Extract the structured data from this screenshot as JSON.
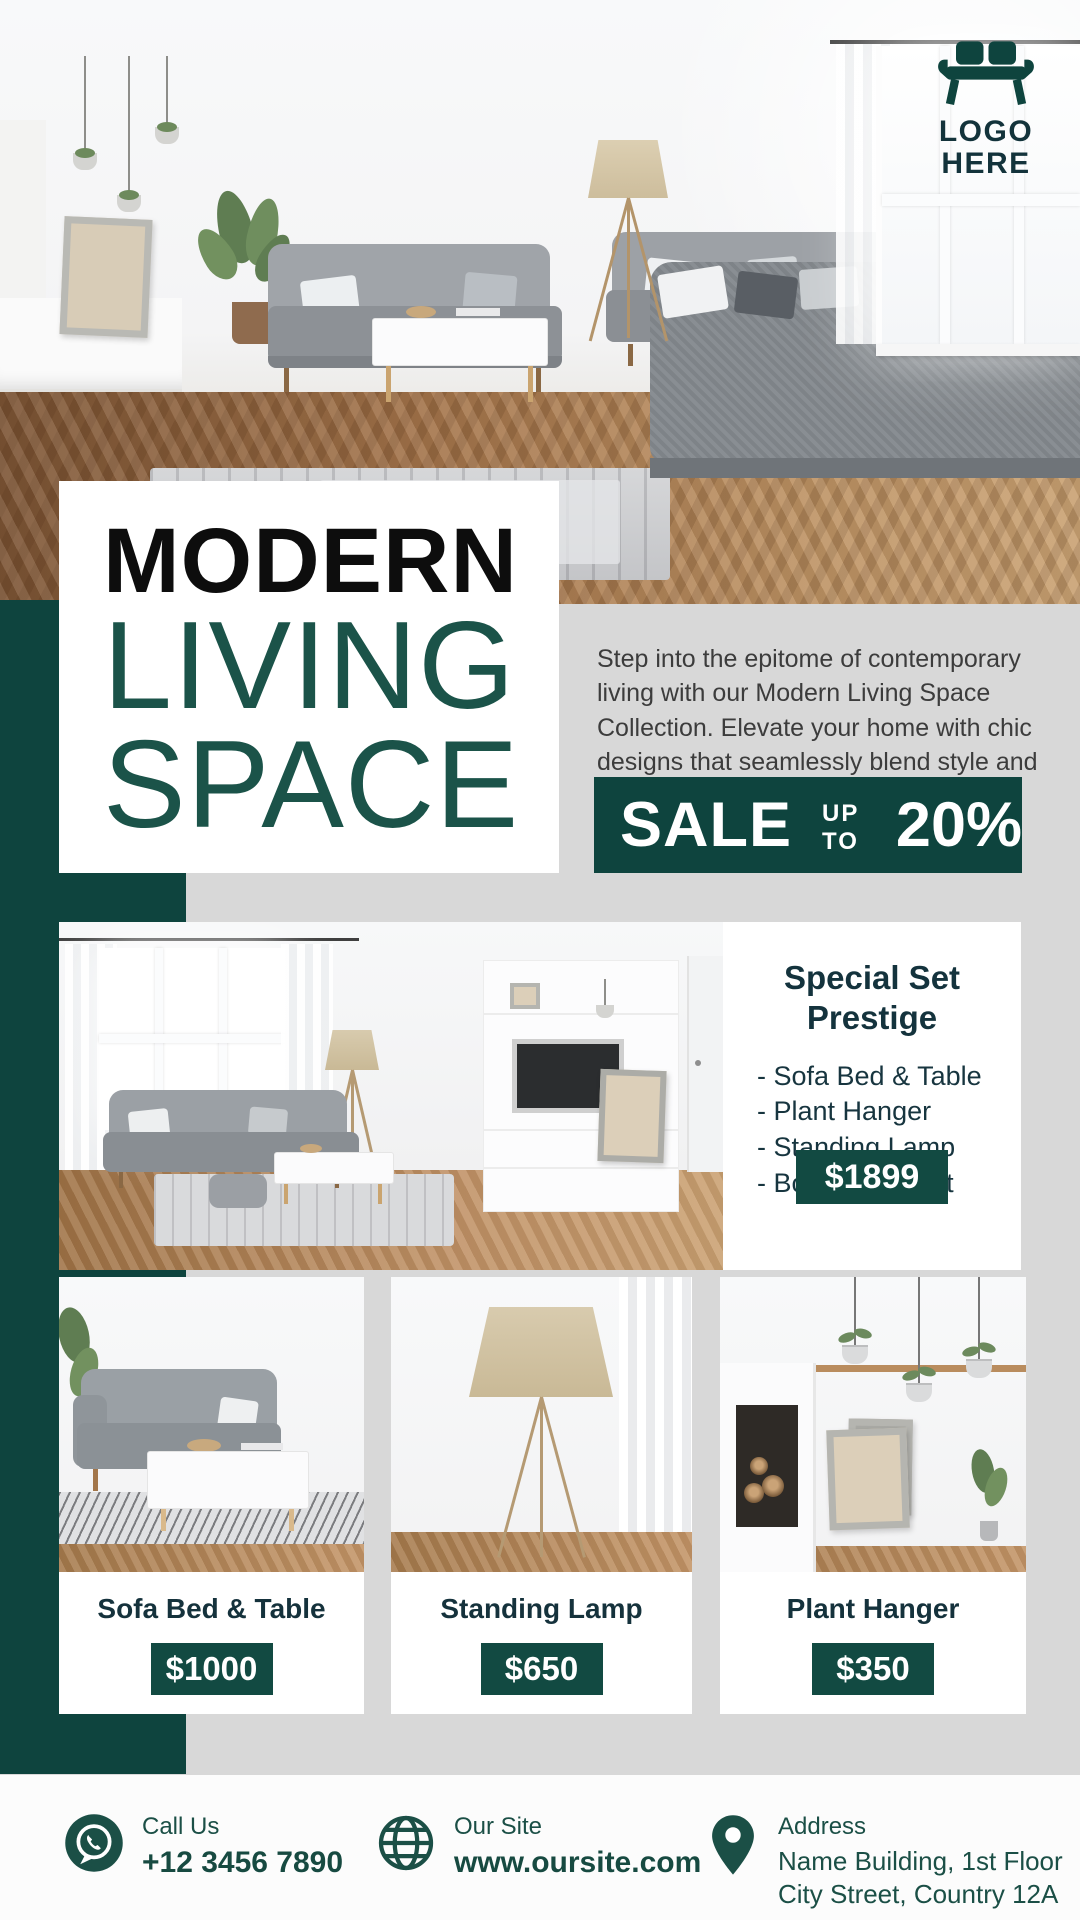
{
  "logo": {
    "icon": "sofa-icon",
    "line1": "LOGO",
    "line2": "HERE"
  },
  "title": {
    "word1": "MODERN",
    "word2": "LIVING",
    "word3": "SPACE"
  },
  "intro": "Step into the epitome of contemporary living with our Modern Living Space Collection. Elevate your home with chic designs that seamlessly blend style and comfort.",
  "sale": {
    "label": "SALE",
    "upto": "UP TO",
    "percent": "20%"
  },
  "special": {
    "title_line1": "Special Set",
    "title_line2": "Prestige",
    "items": [
      "- Sofa Bed & Table",
      "- Plant Hanger",
      "- Standing Lamp",
      "- Bonus : Carpet"
    ],
    "price": "$1899"
  },
  "products": [
    {
      "name": "Sofa Bed & Table",
      "price": "$1000"
    },
    {
      "name": "Standing Lamp",
      "price": "$650"
    },
    {
      "name": "Plant Hanger",
      "price": "$350"
    }
  ],
  "footer": {
    "call": {
      "icon": "whatsapp-icon",
      "label": "Call Us",
      "value": "+12 3456 7890"
    },
    "site": {
      "icon": "globe-icon",
      "label": "Our Site",
      "value": "www.oursite.com"
    },
    "address": {
      "icon": "location-pin-icon",
      "label": "Address",
      "line1": "Name Building, 1st Floor",
      "line2": "City Street, Country 12A"
    }
  },
  "colors": {
    "teal": "#0e443e",
    "teal_badge": "#124a42",
    "teal_text": "#1b4f46",
    "gray_bg": "#d8d8d8",
    "title_black": "#0d0d0d",
    "title_teal": "#1b5349"
  }
}
